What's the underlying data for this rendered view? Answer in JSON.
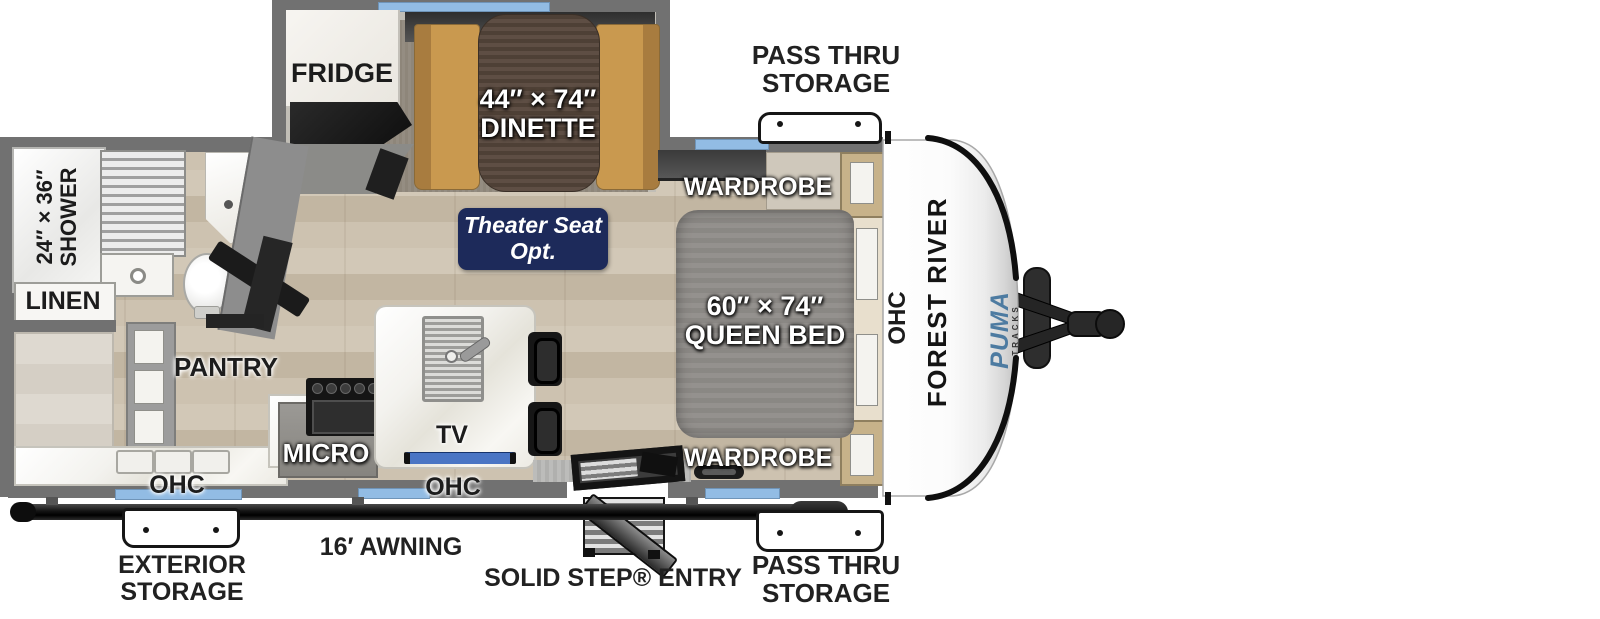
{
  "colors": {
    "wall_gray": "#717171",
    "window_blue": "#92bce4",
    "tv_blue": "#4a75c4",
    "badge_navy": "#1d2a5a",
    "puma_blue": "#4d7ba1",
    "floor_wood": "#c9bfae"
  },
  "labels": {
    "pass_thru_top_1": "PASS THRU",
    "pass_thru_top_2": "STORAGE",
    "pass_thru_bottom_1": "PASS THRU",
    "pass_thru_bottom_2": "STORAGE",
    "exterior_storage_1": "EXTERIOR",
    "exterior_storage_2": "STORAGE",
    "awning": "16′ AWNING",
    "solid_step_entry": "SOLID STEP® ENTRY",
    "fridge": "FRIDGE",
    "dinette_size": "44″ × 74″",
    "dinette": "DINETTE",
    "wardrobe_top": "WARDROBE",
    "wardrobe_bottom": "WARDROBE",
    "theater_seat_1": "Theater Seat",
    "theater_seat_2": "Opt.",
    "queen_size": "60″ × 74″",
    "queen_bed": "QUEEN BED",
    "shower_size": "24″ × 36″",
    "shower": "SHOWER",
    "linen": "LINEN",
    "pantry": "PANTRY",
    "micro": "MICRO",
    "tv": "TV",
    "ohc_kitchen_left": "OHC",
    "ohc_kitchen_right": "OHC",
    "ohc_bedroom": "OHC"
  },
  "branding": {
    "manufacturer": "FOREST RIVER",
    "model": "PUMA",
    "series": "TRACKS"
  }
}
